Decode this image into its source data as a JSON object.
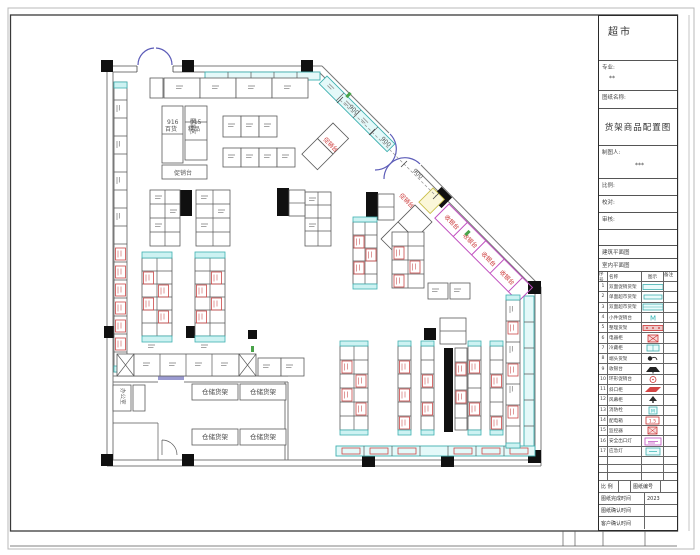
{
  "sheet": {
    "accent_cyan": "#3fb0b0",
    "accent_red": "#cc4848",
    "accent_magenta": "#c050c0",
    "accent_purple": "#5c5cb8"
  },
  "title_block": {
    "project": "超市",
    "major_label": "专业:",
    "major_value": "**",
    "drawing_name_label": "图纸名称:",
    "drawing_name": "货架商品配置图",
    "drafter_label": "制图人:",
    "drafter_value": "***",
    "scale_label": "比例:",
    "proof_label": "校对:",
    "audit_label": "审核:",
    "arch_ref": "建筑平面图",
    "interior_ref": "室内平面图",
    "legend": {
      "headers": [
        "序号",
        "名称",
        "图示",
        "备注"
      ],
      "rows": [
        {
          "no": "1",
          "name": "双面促销货架"
        },
        {
          "no": "2",
          "name": "单面超市货架"
        },
        {
          "no": "3",
          "name": "双面超市货架"
        },
        {
          "no": "4",
          "name": "小件促销台",
          "mark": "M"
        },
        {
          "no": "5",
          "name": "整理货架"
        },
        {
          "no": "6",
          "name": "电器柜"
        },
        {
          "no": "7",
          "name": "冷藏柜"
        },
        {
          "no": "8",
          "name": "端头货架"
        },
        {
          "no": "9",
          "name": "收银台"
        },
        {
          "no": "10",
          "name": "环形促销台"
        },
        {
          "no": "11",
          "name": "斜口柜"
        },
        {
          "no": "12",
          "name": "风幕柜"
        },
        {
          "no": "13",
          "name": "消防栓",
          "mark": "M"
        },
        {
          "no": "14",
          "name": "配电箱",
          "mark": "1.5"
        },
        {
          "no": "15",
          "name": "监控器"
        },
        {
          "no": "16",
          "name": "安全出口灯"
        },
        {
          "no": "17",
          "name": "应急灯"
        }
      ]
    },
    "footer": {
      "scale_label": "比 例",
      "number_label": "图纸编号",
      "finish_label": "图纸完成时间",
      "finish_value": "2023",
      "confirm_label": "图纸确认时间",
      "client_label": "客户确认时间"
    }
  },
  "plan": {
    "labels": {
      "dept_a_code": "916",
      "dept_a_name": "百货",
      "dept_b_code": "915",
      "dept_b_name": "精品",
      "promo_counter": "促销台",
      "promo": "促销台",
      "checkout": "收银台",
      "storage_rack": "仓储货架",
      "clothing_zone": "服装区",
      "office": "办公室"
    },
    "dims": [
      "900",
      "900",
      "900"
    ]
  }
}
